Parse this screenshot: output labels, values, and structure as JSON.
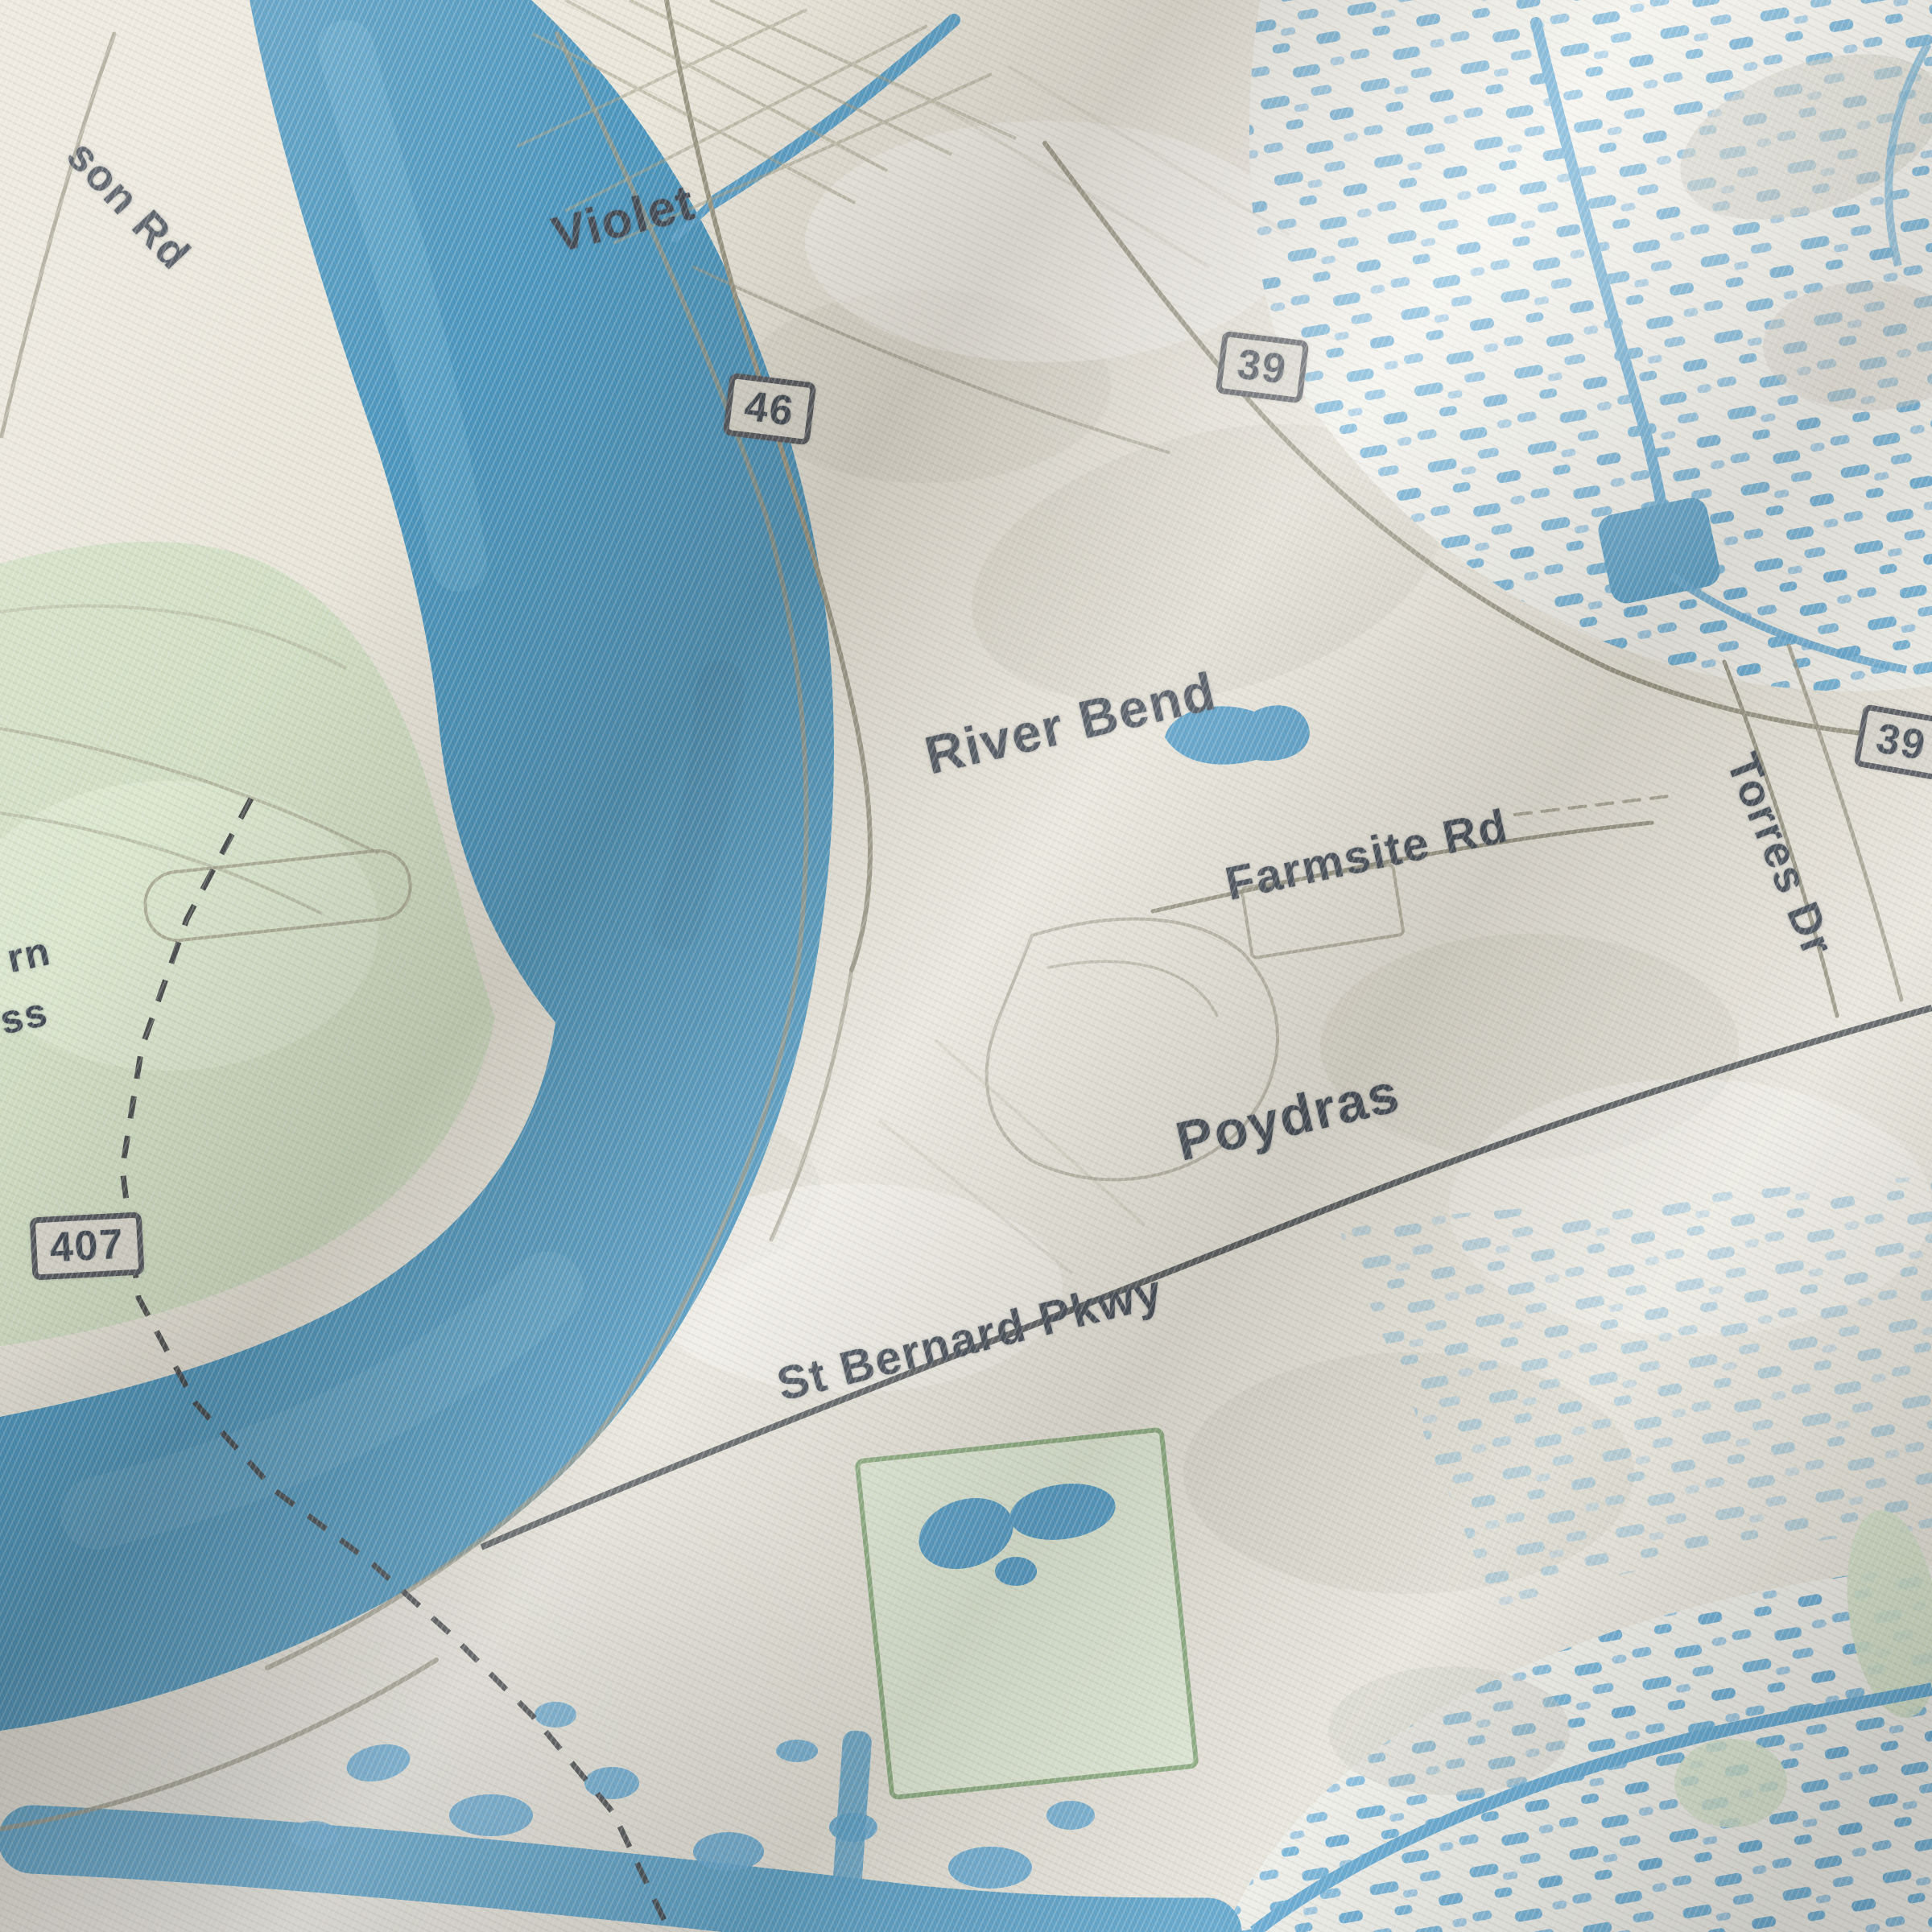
{
  "scene": {
    "subject": "Close-up photograph of a street map printed on woven fabric",
    "area_shown": "River bend area with the towns Violet, Poydras and River Bend"
  },
  "labels": {
    "violet": "Violet",
    "river_bend": "River Bend",
    "farmsite_rd": "Farmsite Rd",
    "torres_dr": "Torres Dr",
    "poydras": "Poydras",
    "st_bernard_pkwy": "St Bernard Pkwy",
    "son_rd_fragment": "son Rd",
    "fragment_rn": "rn",
    "fragment_ss": "ss"
  },
  "route_shields": {
    "route_46": "46",
    "route_39_top": "39",
    "route_39_right": "39",
    "route_407": "407"
  },
  "map_features": [
    {
      "feature": "river-water",
      "color": "#3489b8"
    },
    {
      "feature": "water-highlight",
      "color": "#5fa8cd"
    },
    {
      "feature": "field-green",
      "color": "#cddcbe"
    },
    {
      "feature": "park-green-border",
      "color": "#7fa471"
    },
    {
      "feature": "marsh-dashes",
      "color": "#58a6d4"
    },
    {
      "feature": "canal-stream",
      "color": "#4596c6"
    },
    {
      "feature": "land-cream",
      "color": "#e7e3d7"
    },
    {
      "feature": "minor-road",
      "color": "#8e8b76"
    },
    {
      "feature": "major-road",
      "color": "#34383d"
    },
    {
      "feature": "dashed-boundary",
      "color": "#26282c"
    },
    {
      "feature": "label-text",
      "color": "#2b3440"
    },
    {
      "feature": "shield-fill",
      "color": "#d8d5ca"
    }
  ]
}
